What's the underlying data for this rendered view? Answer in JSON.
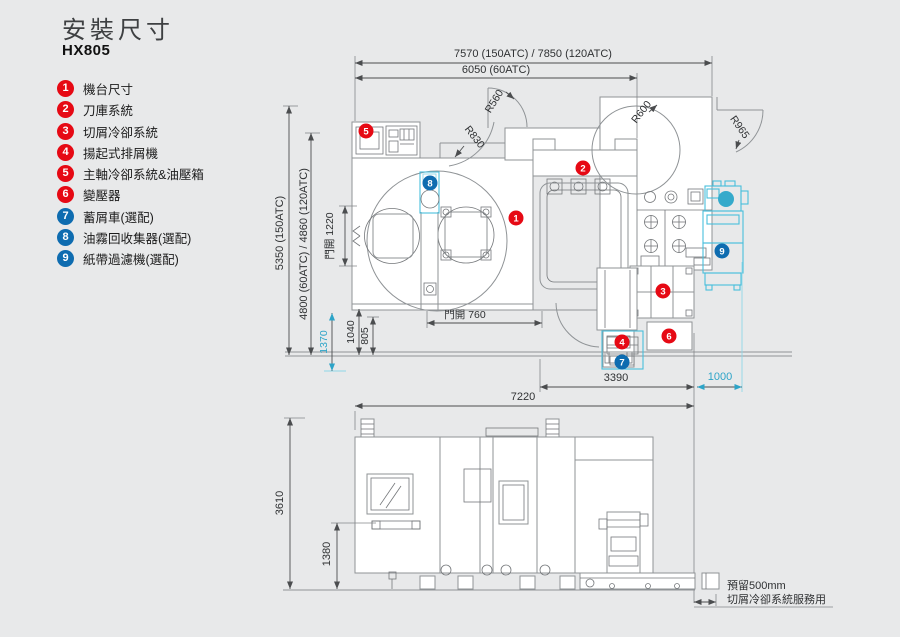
{
  "page": {
    "title": "安裝尺寸",
    "model": "HX805"
  },
  "legend": {
    "items": [
      {
        "num": "1",
        "label": "機台尺寸",
        "color": "#e60914"
      },
      {
        "num": "2",
        "label": "刀庫系統",
        "color": "#e60914"
      },
      {
        "num": "3",
        "label": "切屑冷卻系統",
        "color": "#e60914"
      },
      {
        "num": "4",
        "label": "揚起式排屑機",
        "color": "#e60914"
      },
      {
        "num": "5",
        "label": "主軸冷卻系統&油壓箱",
        "color": "#e60914"
      },
      {
        "num": "6",
        "label": "變壓器",
        "color": "#e60914"
      },
      {
        "num": "7",
        "label": "蓄屑車(選配)",
        "color": "#0e6cb0"
      },
      {
        "num": "8",
        "label": "油霧回收集器(選配)",
        "color": "#0e6cb0"
      },
      {
        "num": "9",
        "label": "紙帶過濾機(選配)",
        "color": "#0e6cb0"
      }
    ]
  },
  "top_view": {
    "dim_width_overall": "7570 (150ATC) / 7850 (120ATC)",
    "dim_width_60": "6050 (60ATC)",
    "dim_depth_overall": "5350 (150ATC)",
    "dim_depth_inner": "4800 (60ATC) / 4860 (120ATC)",
    "dim_door_side": "門開 1220",
    "dim_1370": "1370",
    "dim_1040": "1040",
    "dim_805": "805",
    "dim_door_front": "門開 760",
    "dim_3390": "3390",
    "dim_1000": "1000",
    "r560": "R560",
    "r600": "R600",
    "r830": "R830",
    "r965": "R965"
  },
  "front_view": {
    "dim_width": "7220",
    "dim_height": "3610",
    "dim_1380": "1380",
    "note_line1": "預留500mm",
    "note_line2": "切屑冷卻系統服務用"
  },
  "colors": {
    "accent_red": "#e60914",
    "accent_blue": "#0e6cb0",
    "optional_cyan": "#49bedb",
    "dim_line": "#4b4d4f",
    "machine_line": "#8f9396",
    "background": "#e8e9ea"
  }
}
